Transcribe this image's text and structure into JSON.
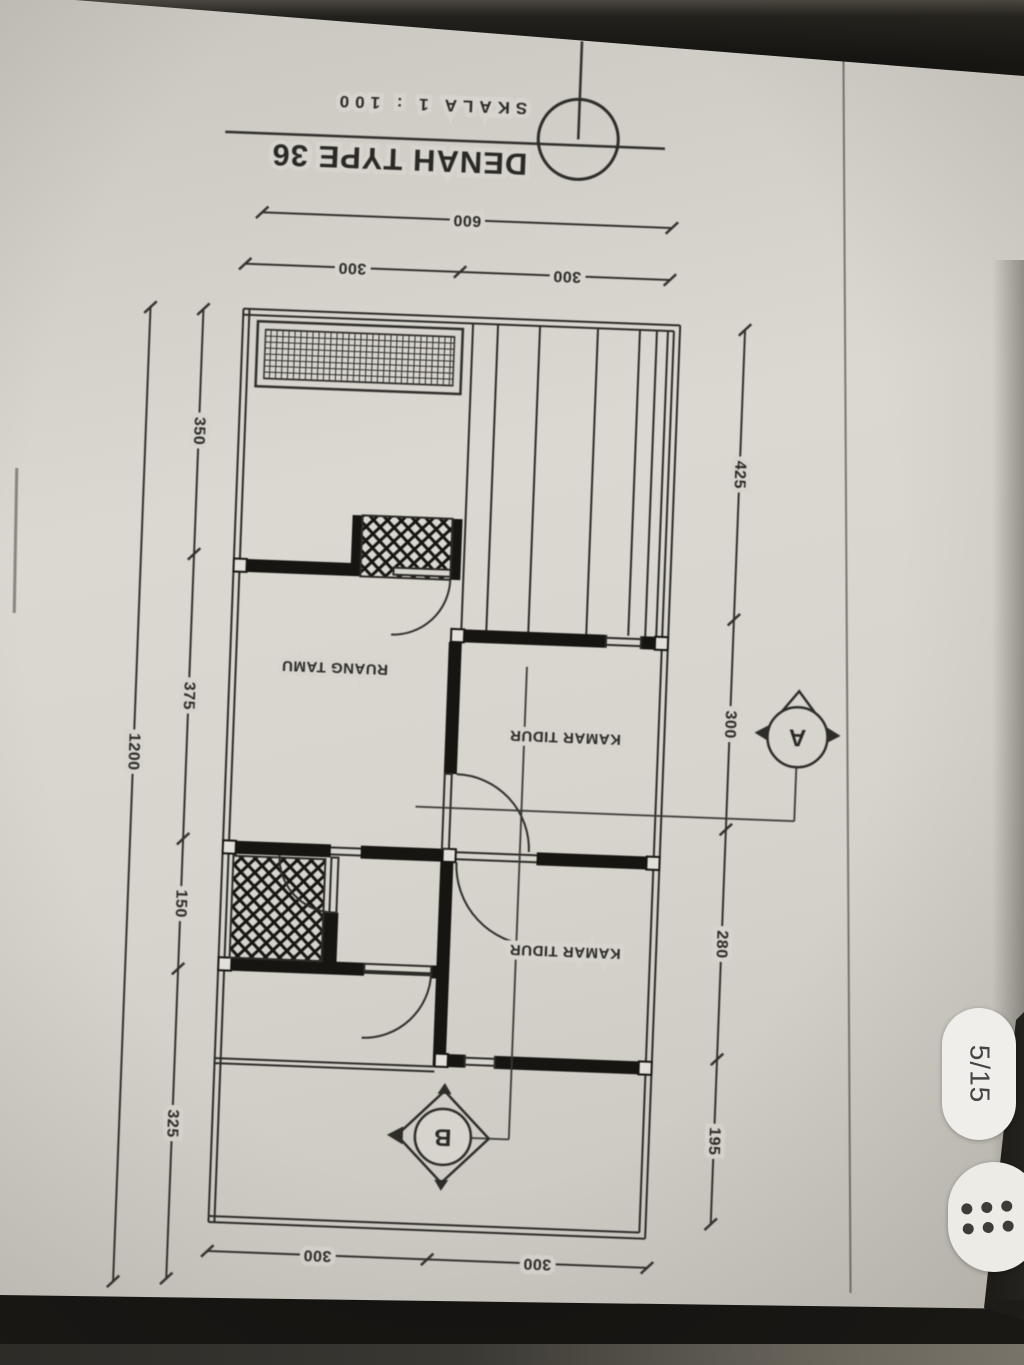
{
  "viewer": {
    "page_indicator": "5/15",
    "menu_icon": "grid-dots-icon"
  },
  "drawing": {
    "title": "DENAH TYPE 36",
    "scale": "SKALA 1 : 100",
    "orientation_note": "page photographed upside-down",
    "rooms": {
      "living": "RUANG TAMU",
      "bedroom1": "KAMAR TIDUR",
      "bedroom2": "KAMAR TIDUR"
    },
    "sections": {
      "a": "A",
      "b": "B"
    },
    "dims": {
      "top_width": "600",
      "top_left": "300",
      "top_right": "300",
      "bottom_left": "300",
      "bottom_right": "300",
      "left_total": "1200",
      "left_1": "350",
      "left_2": "375",
      "left_3": "150",
      "left_4": "325",
      "right_1": "425",
      "right_2": "300",
      "right_3": "280",
      "right_4": "195"
    }
  },
  "colors": {
    "paper": "#d7d4cd",
    "ink": "#2e2c29",
    "wall": "#171512",
    "background_dark": "#141311",
    "pill_bg": "#f0eeea"
  }
}
